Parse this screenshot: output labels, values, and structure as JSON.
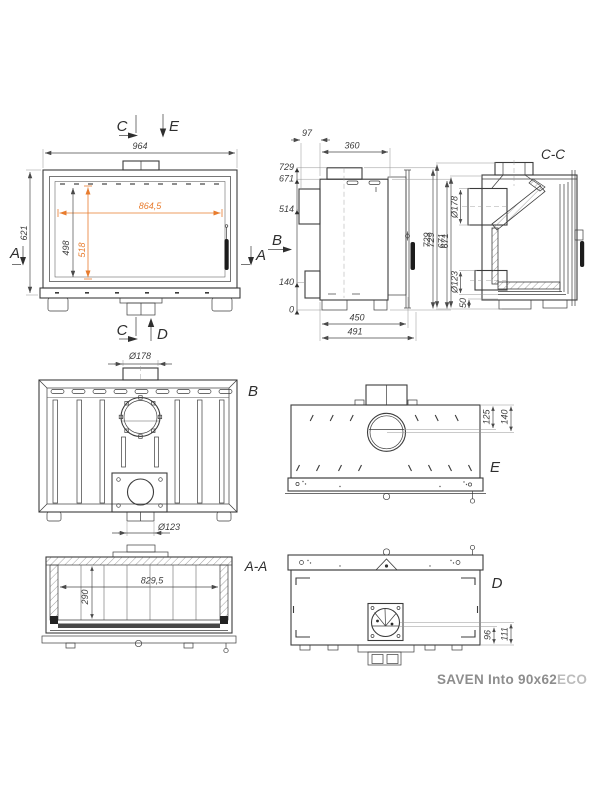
{
  "product": {
    "name": "SAVEN Into 90x62",
    "variant": "ECO"
  },
  "colors": {
    "line": "#3c3c3c",
    "dimension": "#4a4a4a",
    "accent_orange": "#e87c2e",
    "title_gray": "#8d8d8d",
    "title_light_gray": "#bcbcbc"
  },
  "front_view": {
    "marker_c_top": "C",
    "marker_e": "E",
    "marker_c_bottom": "C",
    "marker_d": "D",
    "marker_a_left": "A",
    "marker_a_right": "A",
    "dim_total_width": "964",
    "dim_total_height": "621",
    "dim_glass_width": "864,5",
    "dim_glass_height": "518",
    "dim_door_height": "498"
  },
  "side_view": {
    "label_b": "B",
    "dim_rear_offset": "97",
    "dim_top_depth": "360",
    "heights": {
      "h729": "729",
      "h671": "671",
      "h514": "514",
      "h140": "140",
      "h0": "0"
    },
    "dim_depth_inner": "450",
    "dim_depth_total": "491",
    "dim_right_total": "729",
    "dim_right_body": "671"
  },
  "section_cc": {
    "title": "C-C",
    "dim_total": "729",
    "dim_body": "671",
    "dim_flue": "Ø178",
    "dim_outlet": "Ø123",
    "dim_base": "50"
  },
  "rear_view": {
    "label": "B",
    "dim_flue": "Ø178",
    "dim_outlet": "Ø123"
  },
  "top_view": {
    "label": "E",
    "dim_flue_front": "125",
    "dim_flue_center": "140"
  },
  "section_aa": {
    "title": "A-A",
    "dim_inner_width": "829,5",
    "dim_inner_height": "290"
  },
  "bottom_view": {
    "label": "D",
    "dim_96": "96",
    "dim_111": "111"
  }
}
